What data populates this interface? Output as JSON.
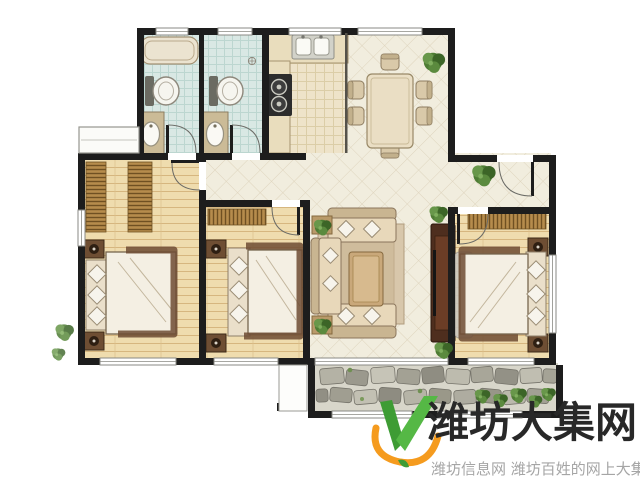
{
  "watermark": {
    "title": "潍坊大集网",
    "subtitle": "潍坊信息网 潍坊百姓的网上大集",
    "title_color": "#282828",
    "subtitle_color": "#a5a5a5",
    "logo": {
      "green_dark": "#3e9c34",
      "green_light": "#55b845",
      "orange": "#f59b1e"
    }
  },
  "floorplan": {
    "rooms": [
      "bathroom-ensuite",
      "bathroom",
      "kitchen",
      "dining-area",
      "entry-foyer",
      "bedroom-left",
      "bedroom-middle",
      "living-room",
      "bedroom-master",
      "balcony",
      "equipment-platform",
      "bay-window"
    ],
    "colors": {
      "wall": "#1d1d1d",
      "diamond_tile": "#f1edde",
      "diamond_tile_line": "#ded4bd",
      "wood_floor": "#efdcae",
      "wood_floor_line": "#d3b078",
      "bath_tile": "#d9e8e4",
      "kitchen_tile": "#eee3c9",
      "balcony_stone": "#a9a79a",
      "plant_green": "#4e7c34",
      "sofa_beige": "#e8d8ba",
      "tv_cabinet": "#4e2e1e"
    }
  }
}
